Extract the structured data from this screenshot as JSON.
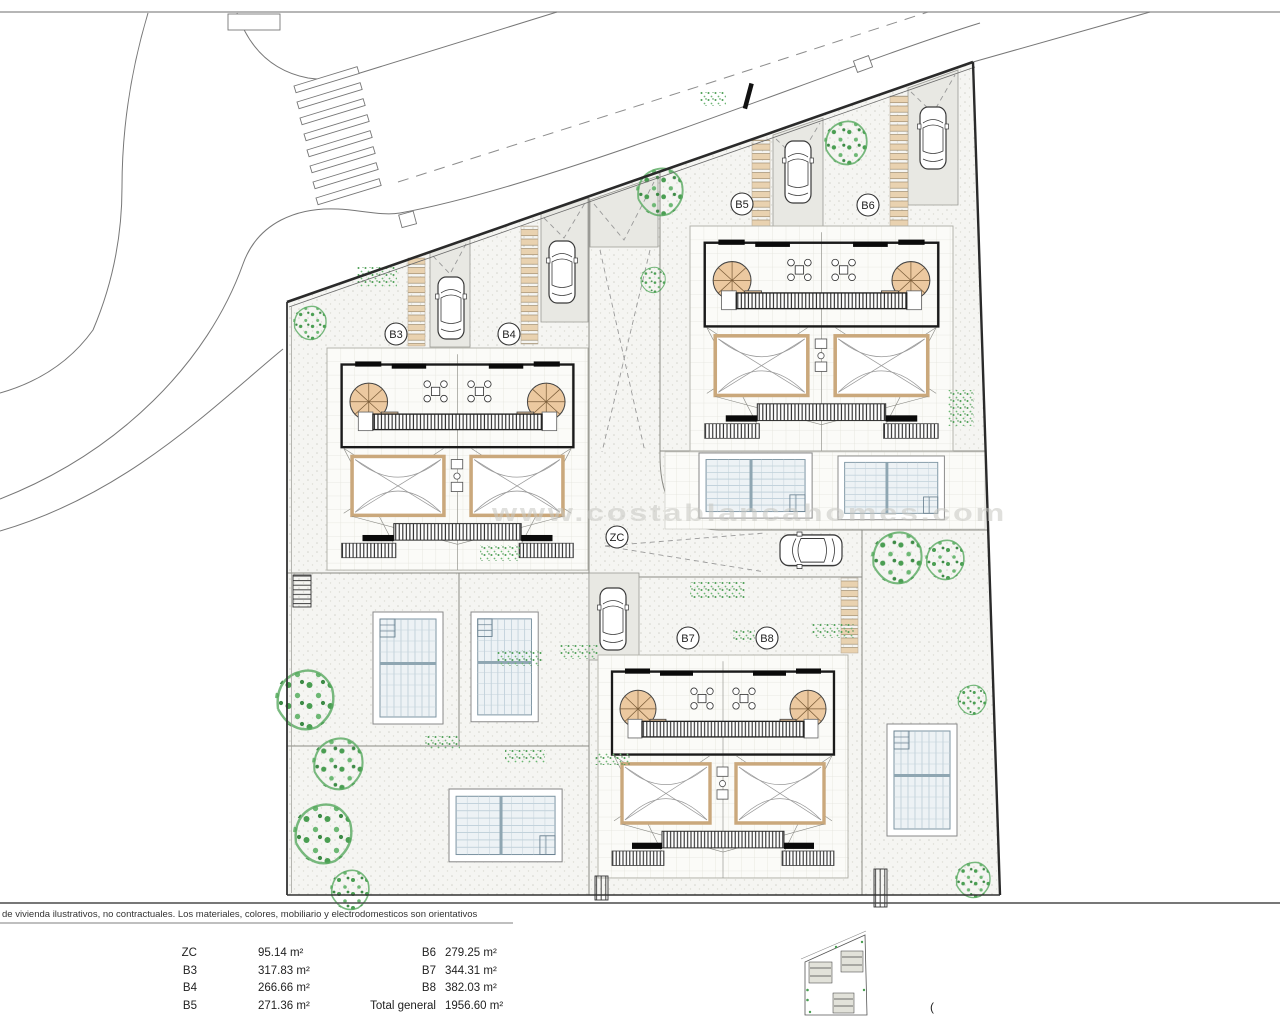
{
  "plan": {
    "watermark": "www.costablancahomes.com",
    "unit_labels": {
      "zc": "ZC",
      "b3": "B3",
      "b4": "B4",
      "b5": "B5",
      "b6": "B6",
      "b7": "B7",
      "b8": "B8"
    }
  },
  "footer": {
    "disclaimer": "de vivienda ilustrativos, no contractuales. Los materiales, colores, mobiliario y electrodomesticos son orientativos",
    "cropped_text": "(",
    "legend": {
      "col1": [
        {
          "label": "ZC",
          "value": "95.14 m²"
        },
        {
          "label": "B3",
          "value": "317.83 m²"
        },
        {
          "label": "B4",
          "value": "266.66 m²"
        },
        {
          "label": "B5",
          "value": "271.36 m²"
        }
      ],
      "col2": [
        {
          "label": "B6",
          "value": "279.25 m²"
        },
        {
          "label": "B7",
          "value": "344.31 m²"
        },
        {
          "label": "B8",
          "value": "382.03 m²"
        },
        {
          "label": "Total general",
          "value": "1956.60 m²"
        }
      ]
    }
  },
  "colors": {
    "paver_tan": "#e9d2b0",
    "stair_tan": "#ecc9a0",
    "tree_green": "#4a9e52",
    "pool_line": "#a9bfcc",
    "boundary": "#2a2a2a"
  }
}
